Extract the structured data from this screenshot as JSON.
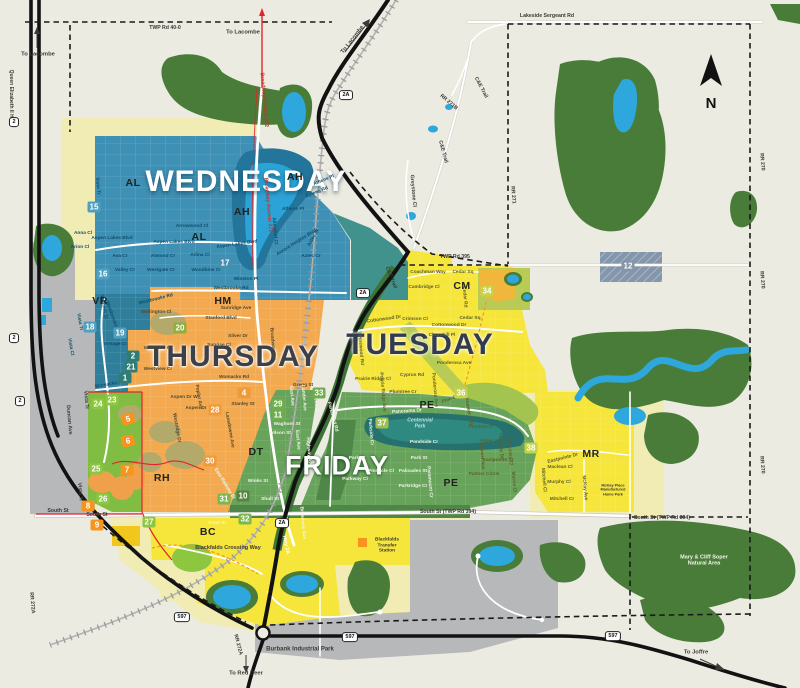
{
  "zones": [
    {
      "id": "wednesday",
      "label": "WEDNESDAY",
      "color": "#3e90b4"
    },
    {
      "id": "thursday",
      "label": "THURSDAY",
      "color": "#f3a94f"
    },
    {
      "id": "tuesday",
      "label": "TUESDAY",
      "color": "#f6e53b"
    },
    {
      "id": "friday",
      "label": "FRIDAY",
      "color": "#68a35b"
    }
  ],
  "compass": {
    "label": "N"
  },
  "neighborhood_codes": [
    {
      "t": "AH",
      "x": 295,
      "y": 177
    },
    {
      "t": "AH",
      "x": 242,
      "y": 212
    },
    {
      "t": "AL",
      "x": 133,
      "y": 183
    },
    {
      "t": "AL",
      "x": 199,
      "y": 237
    },
    {
      "t": "VR",
      "x": 100,
      "y": 301
    },
    {
      "t": "HM",
      "x": 223,
      "y": 301
    },
    {
      "t": "DT",
      "x": 256,
      "y": 452
    },
    {
      "t": "RH",
      "x": 162,
      "y": 478
    },
    {
      "t": "BC",
      "x": 208,
      "y": 532
    },
    {
      "t": "PE",
      "x": 427,
      "y": 405
    },
    {
      "t": "PE",
      "x": 451,
      "y": 483
    },
    {
      "t": "CM",
      "x": 462,
      "y": 286
    },
    {
      "t": "MR",
      "x": 591,
      "y": 454
    }
  ],
  "labels": {
    "streets": [
      {
        "t": "Vista Tr",
        "x": 97,
        "y": 186,
        "r": 85,
        "c": "b"
      },
      {
        "t": "Anna Cl",
        "x": 83,
        "y": 234,
        "c": "b"
      },
      {
        "t": "Arion Cl",
        "x": 80,
        "y": 248,
        "c": "b"
      },
      {
        "t": "Ava Cr",
        "x": 120,
        "y": 257,
        "c": "b"
      },
      {
        "t": "Valley Cr",
        "x": 125,
        "y": 271,
        "c": "b"
      },
      {
        "t": "Aspen Lakes Blvd",
        "x": 112,
        "y": 239,
        "c": "b"
      },
      {
        "t": "Aspen Lakes Blvd",
        "x": 174,
        "y": 243,
        "c": "b"
      },
      {
        "t": "Aspen Lakes Blvd",
        "x": 237,
        "y": 245,
        "r": -8,
        "c": "b"
      },
      {
        "t": "Arrowwood Cl",
        "x": 192,
        "y": 227,
        "c": "b"
      },
      {
        "t": "Almond Cr",
        "x": 163,
        "y": 257,
        "c": "b"
      },
      {
        "t": "Westgate Cr",
        "x": 161,
        "y": 271,
        "c": "b"
      },
      {
        "t": "Adina Cl",
        "x": 200,
        "y": 256,
        "c": "b"
      },
      {
        "t": "Woodbine Cl",
        "x": 206,
        "y": 271,
        "c": "b"
      },
      {
        "t": "Winston Pl",
        "x": 246,
        "y": 280,
        "c": "b"
      },
      {
        "t": "Westbrooke Rd",
        "x": 231,
        "y": 289,
        "c": "b"
      },
      {
        "t": "Westbrooke Rd",
        "x": 156,
        "y": 300,
        "r": -14,
        "c": "b"
      },
      {
        "t": "Athens Pl",
        "x": 324,
        "y": 181,
        "r": -22,
        "c": "b"
      },
      {
        "t": "Athens Rd",
        "x": 317,
        "y": 193,
        "r": -22,
        "c": "b"
      },
      {
        "t": "Athens Pl",
        "x": 293,
        "y": 210,
        "c": "b"
      },
      {
        "t": "Allendorf Cl",
        "x": 274,
        "y": 231,
        "r": 85,
        "c": "b"
      },
      {
        "t": "Aurora Heights Blvd",
        "x": 297,
        "y": 243,
        "r": -32,
        "c": "b"
      },
      {
        "t": "Aztec St",
        "x": 314,
        "y": 238,
        "r": -60,
        "c": "b"
      },
      {
        "t": "Aztec Cr",
        "x": 311,
        "y": 257,
        "c": "b"
      },
      {
        "t": "Valmont St",
        "x": 103,
        "y": 307,
        "r": 80,
        "c": "b"
      },
      {
        "t": "Vista Tr",
        "x": 79,
        "y": 322,
        "r": 80,
        "c": "b"
      },
      {
        "t": "Vista Cl",
        "x": 70,
        "y": 347,
        "r": 80,
        "c": "b"
      },
      {
        "t": "Westbrooke Rd",
        "x": 112,
        "y": 318,
        "r": 70,
        "c": "b"
      },
      {
        "t": "Vintage Cl",
        "x": 115,
        "y": 345,
        "c": "b"
      },
      {
        "t": "Womacks Rd",
        "x": 110,
        "y": 385,
        "r": -10,
        "c": "b"
      },
      {
        "t": "Wellington Cl",
        "x": 156,
        "y": 313,
        "c": "o"
      },
      {
        "t": "Sunridge Ave",
        "x": 236,
        "y": 309,
        "c": "o"
      },
      {
        "t": "Stanford Blvd",
        "x": 221,
        "y": 319,
        "c": "o"
      },
      {
        "t": "Silver Dr",
        "x": 238,
        "y": 337,
        "c": "o"
      },
      {
        "t": "Sunrise Cl",
        "x": 219,
        "y": 346,
        "c": "o"
      },
      {
        "t": "Westview Cr",
        "x": 158,
        "y": 349,
        "c": "o"
      },
      {
        "t": "Westview Cr",
        "x": 158,
        "y": 370,
        "c": "o"
      },
      {
        "t": "Womacks Rd",
        "x": 234,
        "y": 378,
        "c": "o"
      },
      {
        "t": "Aspen Dr W",
        "x": 184,
        "y": 398,
        "c": "o"
      },
      {
        "t": "Poplar Ave",
        "x": 198,
        "y": 397,
        "r": 80,
        "c": "o"
      },
      {
        "t": "Aspen Dr",
        "x": 196,
        "y": 409,
        "c": "o"
      },
      {
        "t": "Stanley St",
        "x": 243,
        "y": 405,
        "c": "o"
      },
      {
        "t": "Gregg St",
        "x": 303,
        "y": 386,
        "c": "o"
      },
      {
        "t": "Broadway Ave",
        "x": 272,
        "y": 344,
        "r": 85,
        "c": "o"
      },
      {
        "t": "Westridge Dr",
        "x": 176,
        "y": 428,
        "r": 80,
        "c": "o"
      },
      {
        "t": "Lansdowne Ave",
        "x": 229,
        "y": 430,
        "r": 80,
        "c": "o"
      },
      {
        "t": "Coachman Way",
        "x": 428,
        "y": 273,
        "c": "y"
      },
      {
        "t": "Cedar Sq",
        "x": 463,
        "y": 273,
        "c": "y"
      },
      {
        "t": "Cambridge Cl",
        "x": 424,
        "y": 288,
        "c": "y"
      },
      {
        "t": "Crimson Cl",
        "x": 415,
        "y": 320,
        "c": "y"
      },
      {
        "t": "Cedar Sq",
        "x": 470,
        "y": 319,
        "c": "y"
      },
      {
        "t": "Cedar Rd",
        "x": 464,
        "y": 297,
        "r": 85,
        "c": "y"
      },
      {
        "t": "Cottonwood Dr",
        "x": 384,
        "y": 320,
        "r": -8,
        "c": "y"
      },
      {
        "t": "Cottonwood Dr",
        "x": 449,
        "y": 326,
        "c": "y"
      },
      {
        "t": "Churchill Pl",
        "x": 442,
        "y": 336,
        "c": "y"
      },
      {
        "t": "Ponderosa Ave",
        "x": 454,
        "y": 364,
        "c": "y"
      },
      {
        "t": "Ponderosa Ave",
        "x": 434,
        "y": 390,
        "r": 85,
        "c": "y"
      },
      {
        "t": "Cyprus Rd",
        "x": 412,
        "y": 376,
        "c": "y"
      },
      {
        "t": "Prairie Ridge Cl",
        "x": 373,
        "y": 380,
        "c": "y"
      },
      {
        "t": "Prairie Ridge Ave",
        "x": 382,
        "y": 392,
        "r": 85,
        "c": "y"
      },
      {
        "t": "Pinewood Rd",
        "x": 360,
        "y": 350,
        "r": 85,
        "c": "y"
      },
      {
        "t": "Plumtree Cr",
        "x": 403,
        "y": 393,
        "c": "y"
      },
      {
        "t": "Pine Cl",
        "x": 450,
        "y": 400,
        "r": -20,
        "c": "y"
      },
      {
        "t": "Pinetree Cl",
        "x": 481,
        "y": 428,
        "c": "y"
      },
      {
        "t": "Piper Cl",
        "x": 490,
        "y": 442,
        "c": "y"
      },
      {
        "t": "Pioneer Ave",
        "x": 481,
        "y": 456,
        "r": 85,
        "c": "y"
      },
      {
        "t": "Parkway Dr",
        "x": 500,
        "y": 446,
        "r": 85,
        "c": "y"
      },
      {
        "t": "Eastpointe St",
        "x": 498,
        "y": 461,
        "c": "y"
      },
      {
        "t": "Palmer Circle",
        "x": 484,
        "y": 475,
        "c": "y"
      },
      {
        "t": "McKinley Cl",
        "x": 509,
        "y": 452,
        "r": 85,
        "c": "y"
      },
      {
        "t": "Pioneer Way",
        "x": 468,
        "y": 412,
        "r": 78,
        "c": "y"
      },
      {
        "t": "Eastpointe Dr",
        "x": 563,
        "y": 459,
        "r": -14,
        "c": "y"
      },
      {
        "t": "Maclean Cl",
        "x": 560,
        "y": 468,
        "c": "y"
      },
      {
        "t": "Murphy Cl",
        "x": 559,
        "y": 483,
        "c": "y"
      },
      {
        "t": "Mitchell Cr",
        "x": 562,
        "y": 500,
        "c": "y"
      },
      {
        "t": "McKay Ave",
        "x": 584,
        "y": 488,
        "r": 85,
        "c": "y"
      },
      {
        "t": "Morris Cl",
        "x": 513,
        "y": 482,
        "r": 85,
        "c": "y"
      },
      {
        "t": "Mitchell Cl",
        "x": 543,
        "y": 480,
        "r": 85,
        "c": "y"
      },
      {
        "t": "Panorama Dr",
        "x": 407,
        "y": 412,
        "r": -4,
        "c": "g"
      },
      {
        "t": "Pondside Cr",
        "x": 424,
        "y": 443,
        "c": "g"
      },
      {
        "t": "Park St",
        "x": 419,
        "y": 459,
        "c": "g"
      },
      {
        "t": "Park St",
        "x": 357,
        "y": 459,
        "c": "g"
      },
      {
        "t": "Pinnacle Cl",
        "x": 381,
        "y": 472,
        "c": "g"
      },
      {
        "t": "Palisades St",
        "x": 413,
        "y": 472,
        "c": "g"
      },
      {
        "t": "Parkway Cl",
        "x": 355,
        "y": 480,
        "c": "g"
      },
      {
        "t": "Parkridge Cr",
        "x": 413,
        "y": 487,
        "c": "g"
      },
      {
        "t": "Paramount Cr",
        "x": 429,
        "y": 482,
        "r": 85,
        "c": "g"
      },
      {
        "t": "Parkwood Rd",
        "x": 332,
        "y": 417,
        "r": 75,
        "c": "g"
      },
      {
        "t": "Parkside Cr",
        "x": 370,
        "y": 432,
        "r": 85,
        "c": "g"
      },
      {
        "t": "Waghorn St",
        "x": 287,
        "y": 425,
        "c": "g"
      },
      {
        "t": "Wilson St",
        "x": 280,
        "y": 434,
        "c": "g"
      },
      {
        "t": "East Ave",
        "x": 297,
        "y": 440,
        "r": 85,
        "c": "g"
      },
      {
        "t": "Highway Ave",
        "x": 308,
        "y": 452,
        "r": 85,
        "c": "g"
      },
      {
        "t": "Winks St",
        "x": 258,
        "y": 482,
        "c": "g"
      },
      {
        "t": "Shull St",
        "x": 270,
        "y": 500,
        "c": "g"
      },
      {
        "t": "Trout St",
        "x": 217,
        "y": 524,
        "c": "g"
      },
      {
        "t": "East Ave",
        "x": 291,
        "y": 396,
        "r": 85,
        "c": "g"
      },
      {
        "t": "Lander Ave",
        "x": 303,
        "y": 398,
        "r": 85,
        "c": "g"
      },
      {
        "t": "Queen Cl",
        "x": 315,
        "y": 402,
        "r": 85,
        "c": "g"
      },
      {
        "t": "Broadway Ave",
        "x": 302,
        "y": 523,
        "r": 85,
        "c": "g"
      },
      {
        "t": "East Railway St",
        "x": 224,
        "y": 484,
        "r": 58,
        "c": "g"
      }
    ],
    "roads": [
      {
        "t": "TWP Rd 40-0",
        "x": 165,
        "y": 29
      },
      {
        "t": "Lakeside Sergeant Rd",
        "x": 547,
        "y": 17
      },
      {
        "t": "C&E Trail",
        "x": 480,
        "y": 88,
        "r": 62
      },
      {
        "t": "C&E Trail",
        "x": 442,
        "y": 152,
        "r": 75
      },
      {
        "t": "C&E Trail",
        "x": 390,
        "y": 278,
        "r": 68
      },
      {
        "t": "RR 271B",
        "x": 448,
        "y": 103,
        "r": 40
      },
      {
        "t": "Greystone Cl",
        "x": 412,
        "y": 191,
        "r": 85
      },
      {
        "t": "TWP Rd 395",
        "x": 455,
        "y": 258
      },
      {
        "t": "RR 271",
        "x": 512,
        "y": 195,
        "r": 85
      },
      {
        "t": "RR 270",
        "x": 761,
        "y": 162,
        "r": 85
      },
      {
        "t": "RR 270",
        "x": 761,
        "y": 280,
        "r": 85
      },
      {
        "t": "RR 270",
        "x": 761,
        "y": 465,
        "r": 85
      },
      {
        "t": "Queen Elizabeth II Hwy",
        "x": 10,
        "y": 97,
        "r": 90,
        "s": 5
      },
      {
        "t": "South St",
        "x": 58,
        "y": 512
      },
      {
        "t": "South St",
        "x": 97,
        "y": 516
      },
      {
        "t": "South St (TWP Rd 394)",
        "x": 448,
        "y": 513
      },
      {
        "t": "South St (TWP Rd 394)",
        "x": 662,
        "y": 519
      },
      {
        "t": "RR 272A",
        "x": 31,
        "y": 603,
        "r": 85
      },
      {
        "t": "RR 272A",
        "x": 237,
        "y": 645,
        "r": 75
      },
      {
        "t": "Duncan Ave",
        "x": 68,
        "y": 420,
        "r": 85
      },
      {
        "t": "Vista Tr",
        "x": 85,
        "y": 400,
        "r": 85
      },
      {
        "t": "Vista Tr",
        "x": 79,
        "y": 492,
        "r": 85
      },
      {
        "t": "Hwy 2A",
        "x": 285,
        "y": 545,
        "r": 78,
        "c": "w"
      },
      {
        "t": "Broadway Avenue 272",
        "x": 263,
        "y": 100,
        "r": 85,
        "c": "r"
      },
      {
        "t": "Broadway Avenue 272",
        "x": 267,
        "y": 205,
        "r": 85,
        "c": "r"
      }
    ],
    "places": [
      {
        "t": "Burbank Industrial Park",
        "x": 300,
        "y": 650,
        "s": 6
      },
      {
        "t": "Blackfalds Crossing Way",
        "x": 228,
        "y": 548,
        "s": 5.5
      },
      {
        "t": "Blackfalds\nTransfer\nStation",
        "x": 387,
        "y": 546,
        "s": 4.8
      },
      {
        "t": "Mary & Cliff Soper\nNatural Area",
        "x": 704,
        "y": 561,
        "c": "wg",
        "s": 5.5
      },
      {
        "t": "Centennial\nPark",
        "x": 420,
        "y": 424,
        "c": "pk",
        "s": 5
      },
      {
        "t": "McKay Place\nManufactured\nHome Park",
        "x": 613,
        "y": 490,
        "s": 3.8
      }
    ],
    "directions": [
      {
        "t": "To Lacombe",
        "x": 38,
        "y": 55
      },
      {
        "t": "To Lacombe",
        "x": 243,
        "y": 33
      },
      {
        "t": "To Lacombe",
        "x": 353,
        "y": 40,
        "r": -52
      },
      {
        "t": "To Red Deer",
        "x": 246,
        "y": 674
      },
      {
        "t": "To Joffre",
        "x": 696,
        "y": 653
      }
    ]
  },
  "badges": [
    {
      "n": "15",
      "x": 94,
      "y": 207,
      "bg": "#4da0bf"
    },
    {
      "n": "16",
      "x": 103,
      "y": 274,
      "bg": "#4da0bf"
    },
    {
      "n": "17",
      "x": 225,
      "y": 263,
      "bg": "#458fae"
    },
    {
      "n": "18",
      "x": 90,
      "y": 327,
      "bg": "#4da0bf"
    },
    {
      "n": "19",
      "x": 120,
      "y": 333,
      "bg": "#4da0bf"
    },
    {
      "n": "12",
      "x": 628,
      "y": 266,
      "bg": "#8496ab"
    },
    {
      "n": "2",
      "x": 133,
      "y": 356,
      "bg": "#2f7d74"
    },
    {
      "n": "21",
      "x": 131,
      "y": 367,
      "bg": "#2f7d74"
    },
    {
      "n": "1",
      "x": 125,
      "y": 378,
      "bg": "#2f7d74"
    },
    {
      "n": "20",
      "x": 180,
      "y": 328,
      "bg": "#8fae3f"
    },
    {
      "n": "4",
      "x": 244,
      "y": 393,
      "bg": "#ef9b3a"
    },
    {
      "n": "28",
      "x": 215,
      "y": 410,
      "bg": "#ef9b3a"
    },
    {
      "n": "30",
      "x": 210,
      "y": 461,
      "bg": "#ef9b3a"
    },
    {
      "n": "29",
      "x": 278,
      "y": 404,
      "bg": "#6fae4e"
    },
    {
      "n": "11",
      "x": 278,
      "y": 415,
      "bg": "#6fae4e"
    },
    {
      "n": "33",
      "x": 319,
      "y": 393,
      "bg": "#6fae4e"
    },
    {
      "n": "10",
      "x": 243,
      "y": 496,
      "bg": "#55853f"
    },
    {
      "n": "31",
      "x": 224,
      "y": 499,
      "bg": "#79b94e"
    },
    {
      "n": "32",
      "x": 245,
      "y": 519,
      "bg": "#79b94e"
    },
    {
      "n": "23",
      "x": 112,
      "y": 400,
      "bg": "#8dc63f"
    },
    {
      "n": "24",
      "x": 98,
      "y": 404,
      "bg": "#8dc63f"
    },
    {
      "n": "25",
      "x": 96,
      "y": 469,
      "bg": "#8dc63f"
    },
    {
      "n": "26",
      "x": 103,
      "y": 499,
      "bg": "#8dc63f"
    },
    {
      "n": "27",
      "x": 149,
      "y": 522,
      "bg": "#8dc63f"
    },
    {
      "n": "34",
      "x": 487,
      "y": 291,
      "bg": "#c5d34b"
    },
    {
      "n": "36",
      "x": 461,
      "y": 393,
      "bg": "#c5d34b"
    },
    {
      "n": "38",
      "x": 531,
      "y": 448,
      "bg": "#c5d34b"
    },
    {
      "n": "37",
      "x": 382,
      "y": 423,
      "bg": "#9cbf4e"
    },
    {
      "n": "5",
      "x": 128,
      "y": 419,
      "bg": "#f7941d",
      "r": -15
    },
    {
      "n": "6",
      "x": 128,
      "y": 441,
      "bg": "#f7941d",
      "r": -12
    },
    {
      "n": "7",
      "x": 127,
      "y": 470,
      "bg": "#f7941d"
    },
    {
      "n": "8",
      "x": 88,
      "y": 506,
      "bg": "#f7941d"
    },
    {
      "n": "9",
      "x": 97,
      "y": 525,
      "bg": "#f7941d"
    }
  ],
  "shields": [
    {
      "t": "2",
      "x": 14,
      "y": 122
    },
    {
      "t": "2",
      "x": 14,
      "y": 338
    },
    {
      "t": "2",
      "x": 20,
      "y": 401
    },
    {
      "t": "2A",
      "x": 346,
      "y": 95
    },
    {
      "t": "2A",
      "x": 363,
      "y": 293
    },
    {
      "t": "2A",
      "x": 282,
      "y": 523
    },
    {
      "t": "597",
      "x": 182,
      "y": 617
    },
    {
      "t": "597",
      "x": 350,
      "y": 637
    },
    {
      "t": "597",
      "x": 613,
      "y": 636
    }
  ]
}
